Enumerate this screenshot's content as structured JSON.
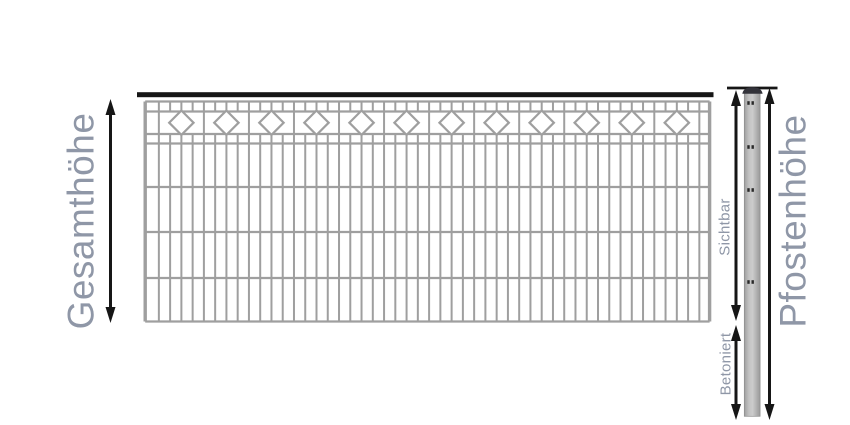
{
  "labels": {
    "gesamthoehe": "Gesamthöhe",
    "pfostenhoehe": "Pfostenhöhe",
    "sichtbar": "Sichtbar",
    "betoniert": "Betoniert"
  },
  "figure": {
    "colors": {
      "label": "#8f97a7",
      "wire": "#9f9f9f",
      "black": "#161616",
      "diamond_fill": "#ffffff",
      "post_border": "#8d8d8d",
      "post_cap": "#33333a",
      "post_mark": "#2a2a2a",
      "post_gradient": [
        "#9f9f9f",
        "#c3c3c3",
        "#cccccc",
        "#b3b3b3",
        "#9a9a9a"
      ]
    },
    "fence": {
      "left": 145.2,
      "right": 709.6,
      "bar": {
        "x": 137,
        "y": 92.2,
        "w": 576.5,
        "h": 5
      },
      "rails_y": [
        101.5,
        111.5,
        134,
        143.5,
        187,
        232,
        278,
        321.5
      ],
      "rail_width": 2.2,
      "edge_width": 3.4,
      "v_start": 147.6,
      "v_spacing": 11.26,
      "v_count": 50,
      "v_width": 2,
      "divider_step": 4,
      "diamonds": {
        "count": 12,
        "cy": 122.7,
        "r": 12.2,
        "stroke_width": 2.2
      }
    },
    "post": {
      "topline": {
        "x1": 727,
        "x2": 777.5,
        "y": 88,
        "width": 2.8
      },
      "x": 744.3,
      "y": 90.5,
      "w": 15.8,
      "h": 325.8,
      "cap": {
        "x1": 742.3,
        "x2": 762.6,
        "y_base": 93.8,
        "y_top": 87.2
      },
      "marks_y": [
        103,
        147,
        190,
        282
      ],
      "mark": {
        "dx": [
          -4.9,
          -0.7
        ],
        "w": 2.4,
        "h": 3.6
      }
    },
    "arrows": [
      {
        "name": "gesamthoehe",
        "x": 110.5,
        "y1": 99,
        "y2": 323
      },
      {
        "name": "sichtbar",
        "x": 736,
        "y1": 90,
        "y2": 321
      },
      {
        "name": "betoniert",
        "x": 736,
        "y1": 325,
        "y2": 420
      },
      {
        "name": "pfostenhoehe",
        "x": 769.5,
        "y1": 88,
        "y2": 420
      }
    ],
    "arrow_style": {
      "line_width": 3,
      "head_len": 16,
      "head_halfwidth": 5
    },
    "label_positions": {
      "gesamthoehe": {
        "x": 81,
        "y": 221
      },
      "sichtbar": {
        "x": 724.5,
        "y": 227
      },
      "betoniert": {
        "x": 725.5,
        "y": 364
      },
      "pfostenhoehe": {
        "x": 793,
        "y": 221
      }
    }
  }
}
